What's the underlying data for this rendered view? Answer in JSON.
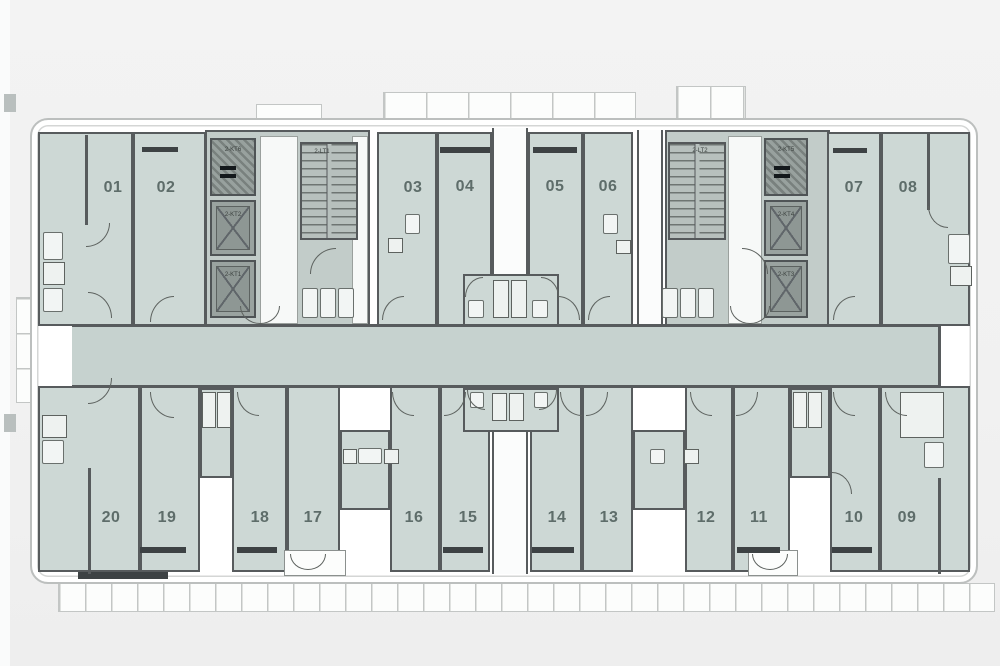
{
  "plan": {
    "kind": "residential tower typical floor plan",
    "unit_numbers_top": [
      "01",
      "02",
      "03",
      "04",
      "05",
      "06",
      "07",
      "08"
    ],
    "unit_numbers_bottom": [
      "20",
      "19",
      "18",
      "17",
      "16",
      "15",
      "14",
      "13",
      "12",
      "11",
      "10",
      "09"
    ],
    "core_left": {
      "stair_label": "2-LT1",
      "machine_label": "2-KT6",
      "lift_labels": [
        "2-KT2",
        "2-KT1"
      ]
    },
    "core_right": {
      "stair_label": "2-LT2",
      "machine_label": "2-KT5",
      "lift_labels": [
        "2-KT4",
        "2-KT3"
      ]
    }
  },
  "colors": {
    "page_bg": "#f1f1f1",
    "paper": "#ffffff",
    "unit_fill": "#cdd8d5",
    "corridor_fill": "#c6d2cf",
    "core_fill": "#c2ccc9",
    "lift_fill": "#9aa3a0",
    "wall": "#575b5d",
    "outer_outline": "#bcbfbe",
    "window_bar": "#3d4244",
    "unit_label_text": "#5e6d6a"
  },
  "symbols": {
    "x_shaft_icon": "crossed box = duct / elevator shaft",
    "stair_icon": "hatched treads = staircase",
    "door_icon": "quarter-circle = door swing",
    "window_icon": "dark bar = window sill",
    "balcony_icon": "ticked strip = balcony railing"
  }
}
